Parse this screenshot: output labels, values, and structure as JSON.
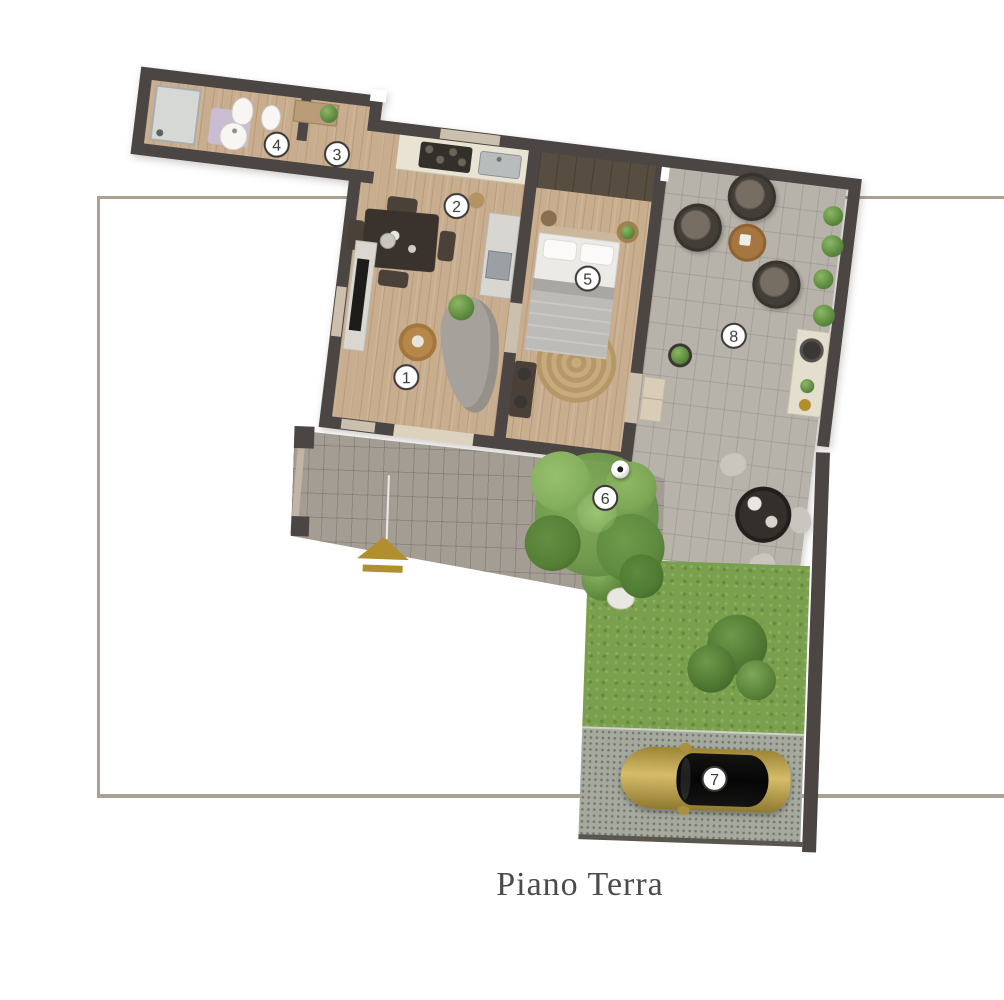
{
  "page": {
    "title_label": "Piano Terra"
  },
  "floor_plan": {
    "rooms": [
      {
        "number": "1"
      },
      {
        "number": "2"
      },
      {
        "number": "3"
      },
      {
        "number": "4"
      },
      {
        "number": "5"
      },
      {
        "number": "6"
      },
      {
        "number": "7"
      },
      {
        "number": "8"
      }
    ],
    "colors": {
      "walls": "#4b4543",
      "wood_floor": "#c8ad8f",
      "terrace_pavers": "#b7b3ab",
      "courtyard_pavers": "#a49d94",
      "grass": "#7aa04d",
      "gravel": "#a6aa9e",
      "car_gold": "#c2a14b",
      "boundary_line": "#aba094",
      "entrance_arrow_gold": "#b28f2e"
    }
  }
}
